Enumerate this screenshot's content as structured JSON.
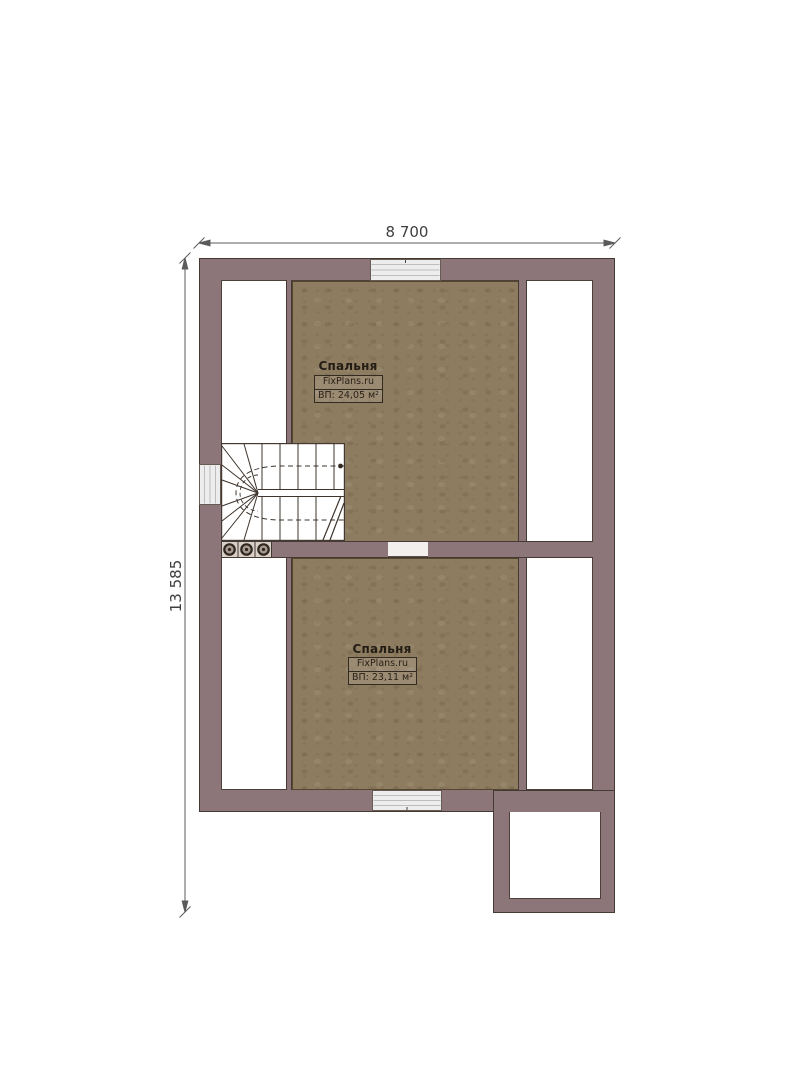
{
  "dimensions": {
    "width": "8 700",
    "height": "13 585"
  },
  "rooms": [
    {
      "name": "Спальня",
      "watermark": "FixPlans.ru",
      "area": "ВП: 24,05 м²"
    },
    {
      "name": "Спальня",
      "watermark": "FixPlans.ru",
      "area": "ВП: 23,11 м²"
    }
  ],
  "symbols": {
    "staircase": "u-shaped-winder-stair",
    "stair_posts": "three-round-posts",
    "windows": [
      "window-top",
      "window-left",
      "window-bottom"
    ],
    "door": "door-opening"
  },
  "colors": {
    "wall": "#8d767a",
    "wall_outline": "#453a33",
    "floor": "#8d7c60",
    "interior": "#ffffff",
    "window": "#ededed",
    "opening": "#f2efec",
    "dimension_text": "#3f3f3f"
  }
}
